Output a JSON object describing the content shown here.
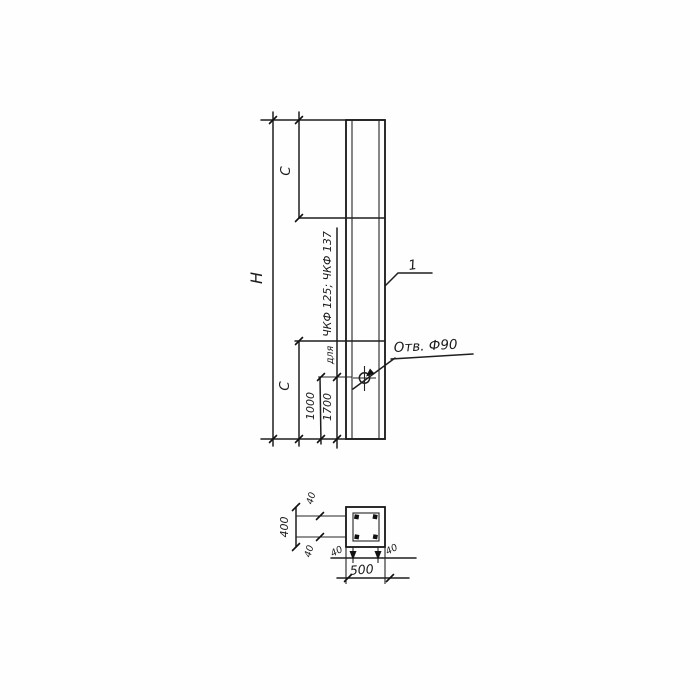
{
  "drawing": {
    "type": "technical-drawing",
    "colors": {
      "line": "#1f1f1f",
      "background": "#fefefe"
    },
    "elevation": {
      "overall_height_label": "H",
      "top_segment_label": "C",
      "bottom_segment_label": "C",
      "hole_offset_primary": "1000",
      "hole_offset_alt": "1700",
      "alt_note_word": "для",
      "alt_note_marks": "ЧКФ 125; ЧКФ 137",
      "hole_note": "Отв. Ф90",
      "item_mark": "1"
    },
    "section": {
      "width_label": "500",
      "height_label": "400",
      "cover_top": "40",
      "cover_bottom": "40",
      "cover_left": "40",
      "cover_right": "40"
    }
  }
}
